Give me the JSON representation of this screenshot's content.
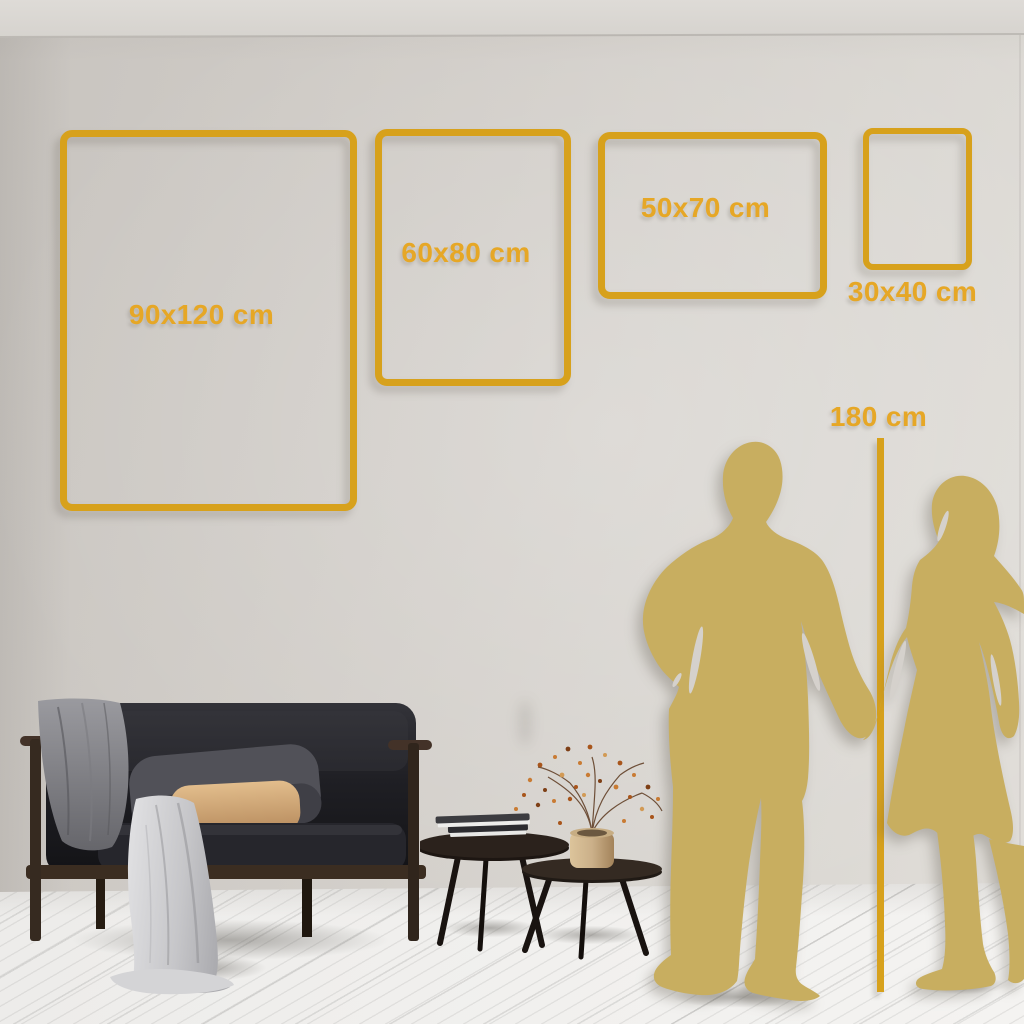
{
  "sizes": [
    {
      "label": "90x120 cm"
    },
    {
      "label": "60x80 cm"
    },
    {
      "label": "50x70 cm"
    },
    {
      "label": "30x40 cm"
    }
  ],
  "reference": {
    "label": "180 cm"
  },
  "colors": {
    "frame_gold": "#d7a11c",
    "label_gold": "#e6a726",
    "silhouette_gold": "#c8ae60",
    "wall": "#d2cec9",
    "floor": "#f1f0ee"
  }
}
